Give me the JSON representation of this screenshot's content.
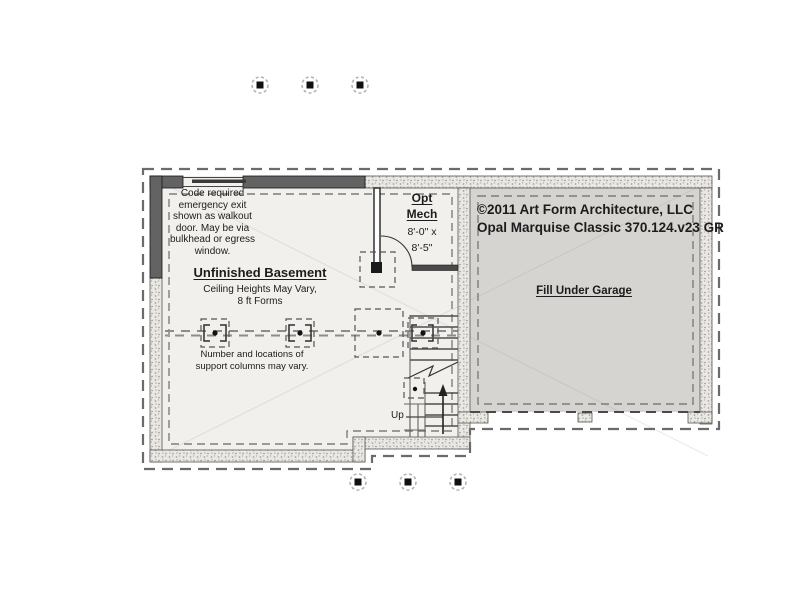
{
  "plan": {
    "egress_note": "Code required\nemergency exit\nshown as walkout\ndoor. May be via\nbulkhead or egress\nwindow.",
    "opt_mech": {
      "title": "Opt\nMech",
      "dims": "8'-0\" x\n8'-5\""
    },
    "room": {
      "title": "Unfinished Basement",
      "subtitle": "Ceiling Heights May Vary,\n8 ft Forms"
    },
    "columns_note": "Number and locations of\nsupport columns may vary.",
    "garage_label": "Fill Under Garage",
    "stairs_label": "Up",
    "copyright_line1": "©2011 Art Form Architecture, LLC",
    "copyright_line2": "Opal Marquise Classic 370.124.v23 GR"
  },
  "colors": {
    "floor_fill": "#f2f0ec",
    "garage_fill": "#d5d4d1",
    "framed_wall": "#636363",
    "concrete_fill": "#eae8e4",
    "dash": "#6b6b6b",
    "text": "#1c1c1c"
  }
}
